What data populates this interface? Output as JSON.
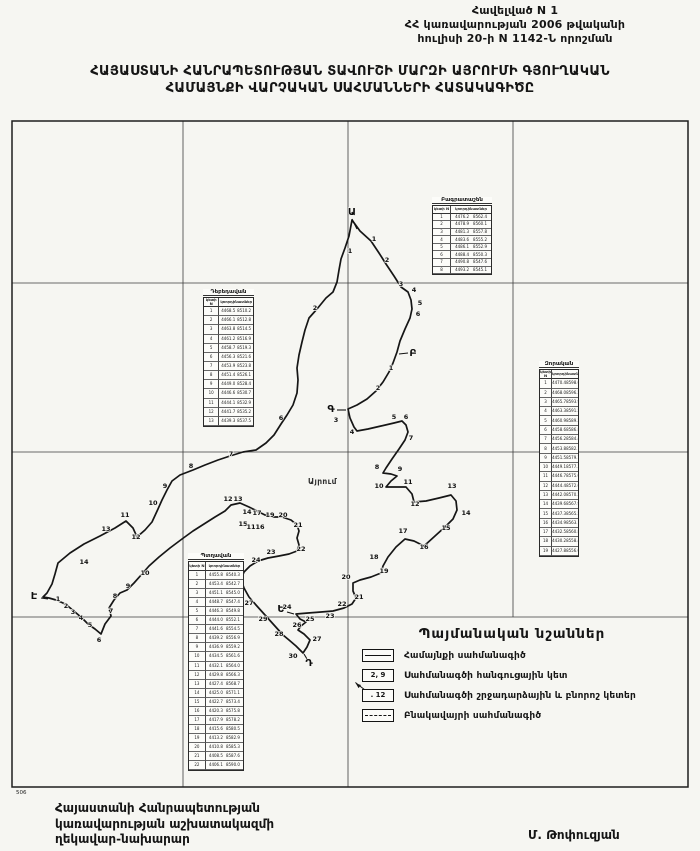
{
  "header": {
    "annex_line1": "Հավելված N 1",
    "annex_line2": "ՀՀ կառավարության 2006 թվականի",
    "annex_line3": "հուլիսի 20-ի N 1142-Ն որոշման",
    "title_line1": "ՀԱՅԱՍՏԱՆԻ ՀԱՆՐԱՊԵՏՈՒԹՅԱՆ ՏԱՎՈՒՇԻ ՄԱՐԶԻ ԱՅՐՈՒՄԻ ԳՅՈՒՂԱԿԱՆ",
    "title_line2": "ՀԱՄԱՅՆՔԻ ՎԱՐՉԱԿԱՆ  ՍԱՀՄԱՆՆԵՐԻ ՀԱՏԱԿԱԳԻԾԸ"
  },
  "footer": {
    "left_line1": "Հայաստանի Հանրապետության",
    "left_line2": "կառավարության աշխատակազմի",
    "left_line3": "ղեկավար-նախարար",
    "signature": "Մ. Թոփուզյան"
  },
  "legend": {
    "title": "Պայմանական նշաններ",
    "items": [
      {
        "type": "solid",
        "text": "",
        "label": "Համայնքի սահմանագիծ"
      },
      {
        "type": "node",
        "text": "2, 9",
        "label": "Սահմանագծի հանգուցային կետ"
      },
      {
        "type": "point",
        "text": ". 12",
        "label": "Սահմանագծի շրջադարձային և բնորոշ կետեր"
      },
      {
        "type": "dashed",
        "text": "",
        "label": "Բնակավայրի սահմանագիծ"
      }
    ]
  },
  "map": {
    "frame": {
      "x": 12,
      "y": 121,
      "w": 676,
      "h": 666
    },
    "scale_note": "506",
    "place_label": {
      "text": "Այրում",
      "x": 308,
      "y": 484
    },
    "grid": {
      "v": [
        [
          183,
          121,
          787
        ],
        [
          348,
          121,
          787
        ],
        [
          513,
          121,
          617
        ]
      ],
      "h": [
        [
          283,
          12,
          688
        ],
        [
          452,
          12,
          688
        ],
        [
          617,
          12,
          688
        ]
      ]
    },
    "boundary": [
      [
        352,
        220
      ],
      [
        360,
        231
      ],
      [
        371,
        241
      ],
      [
        379,
        253
      ],
      [
        386,
        264
      ],
      [
        394,
        276
      ],
      [
        401,
        287
      ],
      [
        408,
        292
      ],
      [
        411,
        300
      ],
      [
        412,
        309
      ],
      [
        410,
        318
      ],
      [
        405,
        329
      ],
      [
        400,
        341
      ],
      [
        397,
        352
      ],
      [
        393,
        363
      ],
      [
        389,
        372
      ],
      [
        383,
        382
      ],
      [
        376,
        391
      ],
      [
        367,
        399
      ],
      [
        357,
        405
      ],
      [
        348,
        409
      ],
      [
        350,
        418
      ],
      [
        354,
        427
      ],
      [
        357,
        431
      ],
      [
        368,
        429
      ],
      [
        381,
        426
      ],
      [
        394,
        423
      ],
      [
        402,
        421
      ],
      [
        406,
        425
      ],
      [
        408,
        432
      ],
      [
        405,
        440
      ],
      [
        399,
        449
      ],
      [
        392,
        459
      ],
      [
        386,
        468
      ],
      [
        383,
        473
      ],
      [
        391,
        474
      ],
      [
        397,
        476
      ],
      [
        391,
        481
      ],
      [
        386,
        487
      ],
      [
        396,
        487
      ],
      [
        406,
        487
      ],
      [
        412,
        494
      ],
      [
        414,
        502
      ],
      [
        426,
        501
      ],
      [
        439,
        498
      ],
      [
        451,
        495
      ],
      [
        456,
        501
      ],
      [
        457,
        510
      ],
      [
        453,
        519
      ],
      [
        446,
        526
      ],
      [
        435,
        536
      ],
      [
        424,
        546
      ],
      [
        414,
        541
      ],
      [
        405,
        539
      ],
      [
        396,
        547
      ],
      [
        388,
        557
      ],
      [
        383,
        566
      ],
      [
        381,
        573
      ],
      [
        371,
        577
      ],
      [
        360,
        580
      ],
      [
        353,
        583
      ],
      [
        353,
        591
      ],
      [
        356,
        598
      ],
      [
        352,
        604
      ],
      [
        344,
        608
      ],
      [
        333,
        611
      ],
      [
        321,
        612
      ],
      [
        308,
        613
      ],
      [
        296,
        614
      ],
      [
        300,
        619
      ],
      [
        306,
        622
      ],
      [
        301,
        626
      ],
      [
        298,
        630
      ],
      [
        304,
        634
      ],
      [
        310,
        640
      ],
      [
        307,
        647
      ],
      [
        303,
        653
      ],
      [
        296,
        646
      ],
      [
        289,
        640
      ],
      [
        283,
        635
      ],
      [
        274,
        625
      ],
      [
        265,
        615
      ],
      [
        256,
        605
      ],
      [
        249,
        597
      ],
      [
        244,
        588
      ],
      [
        241,
        579
      ],
      [
        244,
        572
      ],
      [
        250,
        566
      ],
      [
        258,
        561
      ],
      [
        268,
        558
      ],
      [
        279,
        556
      ],
      [
        289,
        554
      ],
      [
        297,
        551
      ],
      [
        299,
        545
      ],
      [
        297,
        538
      ],
      [
        299,
        531
      ],
      [
        297,
        525
      ],
      [
        291,
        520
      ],
      [
        282,
        517
      ],
      [
        273,
        517
      ],
      [
        265,
        515
      ],
      [
        257,
        511
      ],
      [
        249,
        507
      ],
      [
        240,
        503
      ],
      [
        231,
        505
      ],
      [
        225,
        511
      ],
      [
        215,
        517
      ],
      [
        204,
        524
      ],
      [
        193,
        531
      ],
      [
        182,
        539
      ],
      [
        170,
        548
      ],
      [
        159,
        557
      ],
      [
        149,
        566
      ],
      [
        142,
        574
      ],
      [
        134,
        583
      ],
      [
        127,
        590
      ],
      [
        120,
        593
      ],
      [
        114,
        600
      ],
      [
        109,
        608
      ],
      [
        111,
        616
      ],
      [
        105,
        624
      ],
      [
        101,
        634
      ],
      [
        95,
        629
      ],
      [
        88,
        624
      ],
      [
        82,
        618
      ],
      [
        75,
        612
      ],
      [
        69,
        607
      ],
      [
        63,
        603
      ],
      [
        56,
        600
      ],
      [
        49,
        598
      ],
      [
        43,
        597
      ],
      [
        47,
        593
      ],
      [
        52,
        584
      ],
      [
        55,
        574
      ],
      [
        58,
        563
      ],
      [
        70,
        553
      ],
      [
        84,
        544
      ],
      [
        100,
        536
      ],
      [
        115,
        528
      ],
      [
        126,
        521
      ],
      [
        133,
        528
      ],
      [
        137,
        537
      ],
      [
        145,
        530
      ],
      [
        152,
        522
      ],
      [
        158,
        509
      ],
      [
        162,
        500
      ],
      [
        167,
        490
      ],
      [
        172,
        481
      ],
      [
        180,
        475
      ],
      [
        193,
        470
      ],
      [
        205,
        465
      ],
      [
        218,
        460
      ],
      [
        230,
        456
      ],
      [
        243,
        452
      ],
      [
        256,
        450
      ],
      [
        266,
        443
      ],
      [
        274,
        435
      ],
      [
        281,
        424
      ],
      [
        287,
        415
      ],
      [
        293,
        405
      ],
      [
        297,
        393
      ],
      [
        298,
        380
      ],
      [
        297,
        368
      ],
      [
        299,
        355
      ],
      [
        302,
        342
      ],
      [
        305,
        330
      ],
      [
        309,
        318
      ],
      [
        317,
        309
      ],
      [
        326,
        298
      ],
      [
        333,
        292
      ],
      [
        337,
        282
      ],
      [
        339,
        270
      ],
      [
        341,
        259
      ],
      [
        345,
        248
      ],
      [
        349,
        236
      ]
    ],
    "letters": [
      {
        "t": "Ա",
        "tx": 352,
        "ty": 215,
        "x1": 352,
        "y1": 219,
        "x2": 357,
        "y2": 229
      },
      {
        "t": "Բ",
        "tx": 413,
        "ty": 356,
        "x1": 408,
        "y1": 353,
        "x2": 399,
        "y2": 354
      },
      {
        "t": "Գ",
        "tx": 331,
        "ty": 412,
        "x1": 337,
        "y1": 410,
        "x2": 346,
        "y2": 410
      },
      {
        "t": "Դ",
        "tx": 309,
        "ty": 666,
        "x1": 307,
        "y1": 659,
        "x2": 304,
        "y2": 654
      },
      {
        "t": "Ե",
        "tx": 281,
        "ty": 612,
        "x1": 287,
        "y1": 612,
        "x2": 294,
        "y2": 614
      },
      {
        "t": "Է",
        "tx": 34,
        "ty": 599,
        "x1": 41,
        "y1": 598,
        "x2": 48,
        "y2": 599
      }
    ],
    "points": [
      [
        1,
        374,
        241
      ],
      [
        2,
        387,
        262
      ],
      [
        3,
        401,
        286
      ],
      [
        4,
        414,
        292
      ],
      [
        5,
        420,
        305
      ],
      [
        6,
        418,
        316
      ],
      [
        1,
        350,
        253
      ],
      [
        2,
        315,
        310
      ],
      [
        1,
        391,
        370
      ],
      [
        2,
        378,
        390
      ],
      [
        3,
        336,
        422
      ],
      [
        4,
        352,
        434
      ],
      [
        5,
        394,
        419
      ],
      [
        6,
        406,
        419
      ],
      [
        7,
        411,
        440
      ],
      [
        8,
        377,
        469
      ],
      [
        9,
        400,
        471
      ],
      [
        10,
        379,
        488
      ],
      [
        11,
        408,
        484
      ],
      [
        12,
        415,
        506
      ],
      [
        13,
        452,
        488
      ],
      [
        14,
        466,
        515
      ],
      [
        15,
        446,
        530
      ],
      [
        16,
        424,
        549
      ],
      [
        17,
        403,
        533
      ],
      [
        18,
        374,
        559
      ],
      [
        19,
        384,
        573
      ],
      [
        20,
        346,
        579
      ],
      [
        21,
        359,
        599
      ],
      [
        22,
        342,
        606
      ],
      [
        23,
        330,
        618
      ],
      [
        24,
        287,
        609
      ],
      [
        25,
        310,
        621
      ],
      [
        26,
        297,
        627
      ],
      [
        27,
        317,
        641
      ],
      [
        28,
        279,
        636
      ],
      [
        30,
        293,
        658
      ],
      [
        29,
        263,
        621
      ],
      [
        27,
        249,
        605
      ],
      [
        12,
        228,
        501
      ],
      [
        13,
        238,
        501
      ],
      [
        14,
        247,
        514
      ],
      [
        17,
        257,
        515
      ],
      [
        15,
        243,
        526
      ],
      [
        11,
        251,
        529
      ],
      [
        16,
        260,
        529
      ],
      [
        19,
        270,
        517
      ],
      [
        20,
        283,
        517
      ],
      [
        21,
        298,
        527
      ],
      [
        22,
        301,
        551
      ],
      [
        23,
        271,
        554
      ],
      [
        24,
        256,
        562
      ],
      [
        10,
        145,
        575
      ],
      [
        9,
        128,
        588
      ],
      [
        8,
        115,
        598
      ],
      [
        7,
        111,
        613
      ],
      [
        1,
        58,
        601
      ],
      [
        2,
        66,
        608
      ],
      [
        3,
        73,
        614
      ],
      [
        4,
        81,
        620
      ],
      [
        5,
        90,
        627
      ],
      [
        6,
        99,
        642
      ],
      [
        14,
        84,
        564
      ],
      [
        13,
        106,
        531
      ],
      [
        12,
        136,
        539
      ],
      [
        11,
        125,
        517
      ],
      [
        10,
        153,
        505
      ],
      [
        9,
        165,
        488
      ],
      [
        8,
        191,
        468
      ],
      [
        7,
        231,
        456
      ],
      [
        6,
        281,
        420
      ]
    ],
    "tables": [
      {
        "title": "Բագրատաշեն",
        "x": 432,
        "y": 197,
        "w": 60,
        "h": 68,
        "col1": "կետի N",
        "col2": "կոորդինատներ",
        "rows": [
          [
            "1",
            "4476.2",
            "8562.4"
          ],
          [
            "2",
            "4478.9",
            "8560.1"
          ],
          [
            "3",
            "4481.3",
            "8557.8"
          ],
          [
            "4",
            "4483.6",
            "8555.2"
          ],
          [
            "5",
            "4486.1",
            "8552.9"
          ],
          [
            "6",
            "4488.4",
            "8550.3"
          ],
          [
            "7",
            "4490.8",
            "8547.6"
          ],
          [
            "8",
            "4493.2",
            "8545.1"
          ]
        ]
      },
      {
        "title": "Դեբեդավան",
        "x": 203,
        "y": 289,
        "w": 51,
        "h": 128,
        "col1": "կետի N",
        "col2": "կոորդինատներ",
        "rows": [
          [
            "1",
            "4468.5",
            "8510.2"
          ],
          [
            "2",
            "4466.1",
            "8512.8"
          ],
          [
            "3",
            "4463.8",
            "8514.5"
          ],
          [
            "4",
            "4461.2",
            "8516.9"
          ],
          [
            "5",
            "4458.7",
            "8519.3"
          ],
          [
            "6",
            "4456.3",
            "8521.6"
          ],
          [
            "7",
            "4453.9",
            "8523.8"
          ],
          [
            "8",
            "4451.4",
            "8526.1"
          ],
          [
            "9",
            "4449.0",
            "8528.4"
          ],
          [
            "10",
            "4446.6",
            "8530.7"
          ],
          [
            "11",
            "4444.1",
            "8532.9"
          ],
          [
            "12",
            "4441.7",
            "8535.2"
          ],
          [
            "13",
            "4439.3",
            "8537.5"
          ]
        ]
      },
      {
        "title": "Զորական",
        "x": 539,
        "y": 361,
        "w": 40,
        "h": 186,
        "col1": "կետի N",
        "col2": "կոորդինատներ",
        "rows": [
          [
            "1",
            "4470.4",
            "8598.6"
          ],
          [
            "2",
            "4468.0",
            "8596.2"
          ],
          [
            "3",
            "4465.7",
            "8593.9"
          ],
          [
            "4",
            "4463.3",
            "8591.5"
          ],
          [
            "5",
            "4460.9",
            "8589.2"
          ],
          [
            "6",
            "4458.6",
            "8586.8"
          ],
          [
            "7",
            "4456.2",
            "8584.4"
          ],
          [
            "8",
            "4453.8",
            "8582.1"
          ],
          [
            "9",
            "4451.5",
            "8579.7"
          ],
          [
            "10",
            "4449.1",
            "8577.3"
          ],
          [
            "11",
            "4446.7",
            "8575.0"
          ],
          [
            "12",
            "4444.4",
            "8572.6"
          ],
          [
            "13",
            "4442.0",
            "8570.2"
          ],
          [
            "14",
            "4439.6",
            "8567.9"
          ],
          [
            "15",
            "4437.3",
            "8565.5"
          ],
          [
            "16",
            "4434.9",
            "8563.1"
          ],
          [
            "17",
            "4432.5",
            "8560.8"
          ],
          [
            "18",
            "4430.2",
            "8558.4"
          ],
          [
            "19",
            "4427.8",
            "8556.0"
          ]
        ]
      },
      {
        "title": "Պտղավան",
        "x": 188,
        "y": 553,
        "w": 56,
        "h": 208,
        "col1": "կետի N",
        "col2": "կոորդինատներ",
        "rows": [
          [
            "1",
            "4455.8",
            "8540.3"
          ],
          [
            "2",
            "4453.4",
            "8542.7"
          ],
          [
            "3",
            "4451.1",
            "8545.0"
          ],
          [
            "4",
            "4448.7",
            "8547.4"
          ],
          [
            "5",
            "4446.3",
            "8549.8"
          ],
          [
            "6",
            "4444.0",
            "8552.1"
          ],
          [
            "7",
            "4441.6",
            "8554.5"
          ],
          [
            "8",
            "4439.2",
            "8556.9"
          ],
          [
            "9",
            "4436.9",
            "8559.2"
          ],
          [
            "10",
            "4434.5",
            "8561.6"
          ],
          [
            "11",
            "4432.1",
            "8564.0"
          ],
          [
            "12",
            "4429.8",
            "8566.3"
          ],
          [
            "13",
            "4427.4",
            "8568.7"
          ],
          [
            "14",
            "4425.0",
            "8571.1"
          ],
          [
            "15",
            "4422.7",
            "8573.4"
          ],
          [
            "16",
            "4420.3",
            "8575.8"
          ],
          [
            "17",
            "4417.9",
            "8578.2"
          ],
          [
            "18",
            "4415.6",
            "8580.5"
          ],
          [
            "19",
            "4413.2",
            "8582.9"
          ],
          [
            "20",
            "4410.8",
            "8585.3"
          ],
          [
            "21",
            "4408.5",
            "8587.6"
          ],
          [
            "22",
            "4406.1",
            "8590.0"
          ]
        ]
      }
    ]
  }
}
